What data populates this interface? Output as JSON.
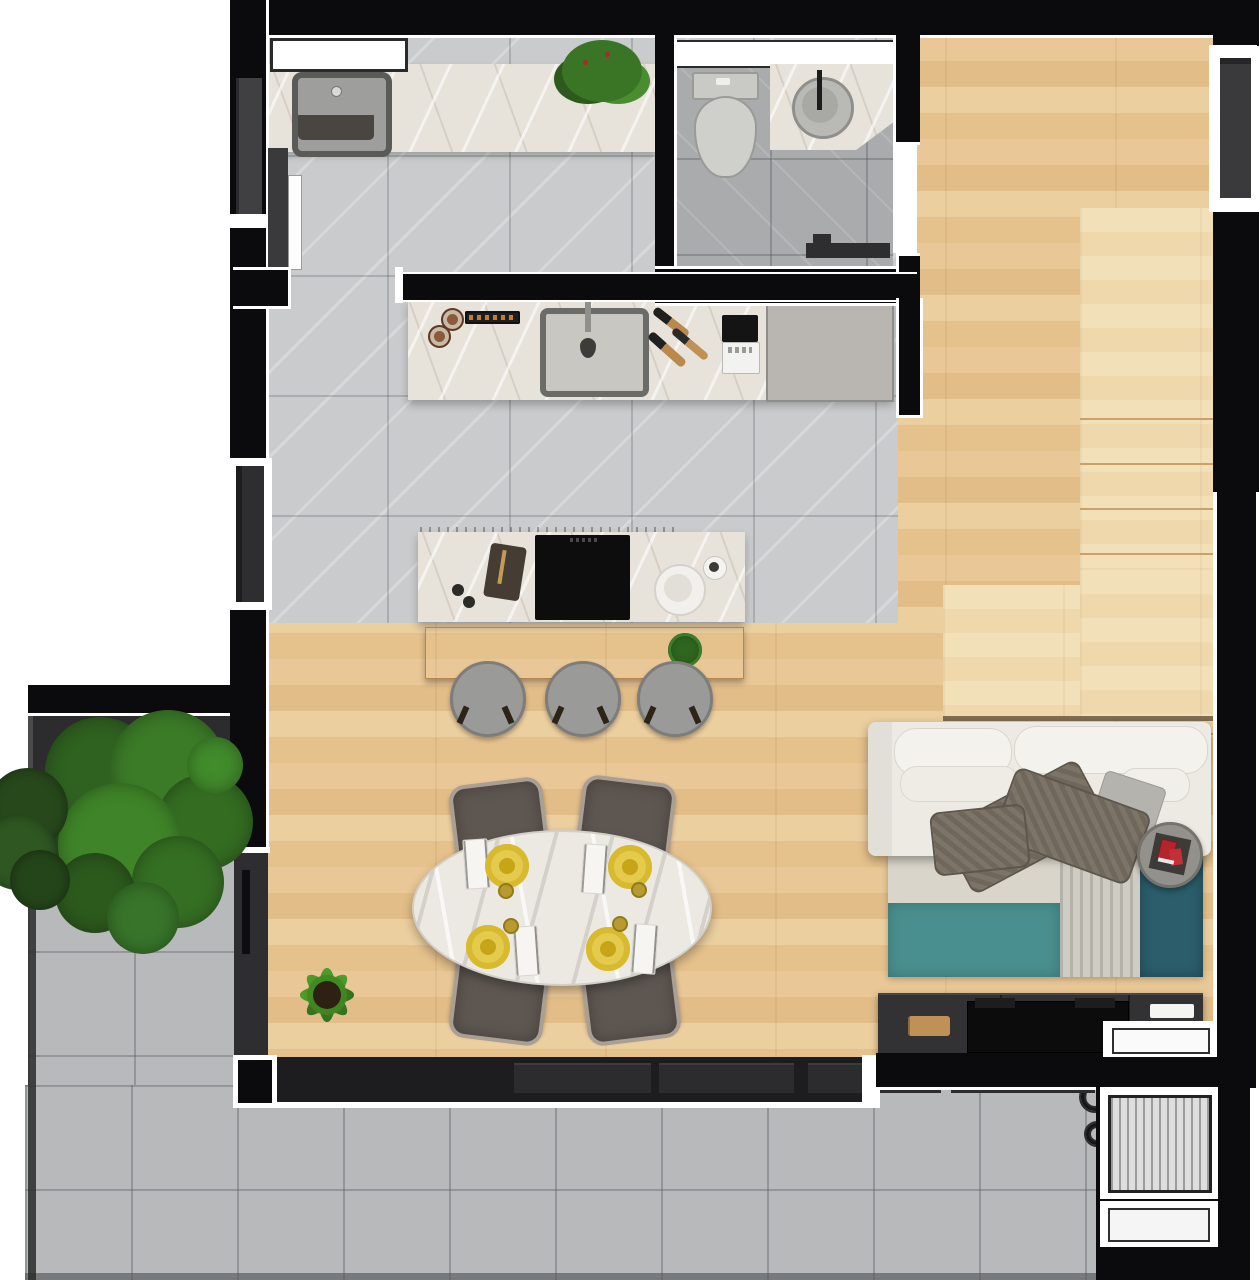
{
  "meta": {
    "kind": "apartment-floor-plan-render",
    "view": "top-down",
    "visible_text": "none"
  },
  "palette": {
    "wall_black": "#0b0b0d",
    "inner_seam_white": "#ffffff",
    "wood_floor": "#e7c493",
    "stair_wood_light": "#f0dcb2",
    "indoor_tile": "#c9cbcc",
    "wc_tile": "#a9abad",
    "outdoor_tile": "#b7b9ba",
    "marble_counter": "#e7e2da",
    "appliance_gray": "#b9b6b1",
    "cooktop_black": "#0d0d0e",
    "glass_dark": "#353538",
    "sofa_white": "#efece6",
    "blanket_taupe": "#6f675c",
    "rug_teal": "#4a8f8f",
    "rug_dark_teal": "#2b5d6b",
    "rug_base": "#d9d5ca",
    "console_dark": "#323234",
    "plate_yellow": "#d8ba2e",
    "accent_red": "#b3242c",
    "plant_green": "#3f7d2c",
    "stool_gray": "#9a9a98",
    "chair_brown": "#5e5751"
  },
  "rooms": [
    {
      "id": "laundry",
      "features": [
        "window",
        "counter",
        "square-sink",
        "plant"
      ]
    },
    {
      "id": "wc",
      "features": [
        "window",
        "toilet",
        "round-basin-vanity",
        "towel-rail",
        "door-opening"
      ]
    },
    {
      "id": "kitchen",
      "features": [
        "back-counter",
        "sink",
        "spice-rack",
        "coffee-maker",
        "appliance-panel",
        "island",
        "cooktop",
        "bench",
        "stools"
      ]
    },
    {
      "id": "dining",
      "features": [
        "oval-marble-table",
        "4-chairs",
        "4-plates",
        "floor-plant"
      ]
    },
    {
      "id": "living",
      "features": [
        "sofa",
        "blanket",
        "pillows",
        "side-table",
        "rug",
        "tv-console"
      ]
    },
    {
      "id": "stairs",
      "features": [
        "upper-flight",
        "landing",
        "lower-steps"
      ]
    },
    {
      "id": "terrace",
      "features": [
        "planter",
        "tree",
        "bush",
        "outdoor-tile"
      ]
    },
    {
      "id": "shaft-corner",
      "features": [
        "window-block",
        "hatched-block",
        "plain-block"
      ]
    }
  ],
  "counts": {
    "stair_treads": 8,
    "lower_steps": 3,
    "stools": 3,
    "dining_chairs": 4,
    "dinner_plates": 4,
    "glass_panels": 4,
    "cooktop_burners": 4
  },
  "stairs": {
    "treads": [
      {
        "y": 210
      },
      {
        "y": 255
      },
      {
        "y": 300
      },
      {
        "y": 345
      },
      {
        "y": 390
      },
      {
        "y": 435
      },
      {
        "y": 480
      },
      {
        "y": 525
      }
    ],
    "lower_steps": [
      {
        "x": 943
      },
      {
        "x": 989
      },
      {
        "x": 1035
      }
    ]
  },
  "glass_panels": [
    {
      "x": 281,
      "w": 137
    },
    {
      "x": 426,
      "w": 135
    },
    {
      "x": 575,
      "w": 133
    },
    {
      "x": 718,
      "w": 144
    }
  ],
  "stools": [
    {
      "cx": 485
    },
    {
      "cx": 580
    },
    {
      "cx": 672
    }
  ],
  "burners": [
    {
      "cx": 558,
      "cy": 560,
      "r": 14
    },
    {
      "cx": 603,
      "cy": 556,
      "r": 11
    },
    {
      "cx": 560,
      "cy": 597,
      "r": 11
    },
    {
      "cx": 606,
      "cy": 593,
      "r": 14
    }
  ],
  "chairs": [
    {
      "x": 452,
      "y": 781,
      "rot": -7
    },
    {
      "x": 579,
      "y": 779,
      "rot": 7
    },
    {
      "x": 452,
      "y": 960,
      "rot": 187
    },
    {
      "x": 584,
      "y": 960,
      "rot": 173
    }
  ],
  "plates": [
    {
      "cx": 507,
      "cy": 866
    },
    {
      "cx": 630,
      "cy": 867
    },
    {
      "cx": 488,
      "cy": 947
    },
    {
      "cx": 608,
      "cy": 949
    }
  ],
  "napkins": [
    {
      "x": 464,
      "y": 839,
      "rot": -4
    },
    {
      "x": 582,
      "y": 844,
      "rot": 4
    },
    {
      "x": 514,
      "y": 926,
      "rot": -4
    },
    {
      "x": 632,
      "y": 924,
      "rot": 4
    }
  ],
  "cups": [
    {
      "cx": 504,
      "cy": 889
    },
    {
      "cx": 637,
      "cy": 888
    },
    {
      "cx": 509,
      "cy": 924
    },
    {
      "cx": 618,
      "cy": 922
    }
  ],
  "tree_blobs": [
    {
      "cx": 138,
      "cy": 825,
      "r": 92,
      "color": "#23481a"
    },
    {
      "cx": 100,
      "cy": 772,
      "r": 55,
      "color": "#2f6120"
    },
    {
      "cx": 168,
      "cy": 768,
      "r": 58,
      "color": "#3b7a27"
    },
    {
      "cx": 205,
      "cy": 822,
      "r": 48,
      "color": "#346c22"
    },
    {
      "cx": 120,
      "cy": 845,
      "r": 62,
      "color": "#3f8428"
    },
    {
      "cx": 178,
      "cy": 882,
      "r": 46,
      "color": "#356f23"
    },
    {
      "cx": 95,
      "cy": 893,
      "r": 40,
      "color": "#2c5a1d"
    },
    {
      "cx": 143,
      "cy": 918,
      "r": 36,
      "color": "#38752a"
    },
    {
      "cx": 215,
      "cy": 765,
      "r": 28,
      "color": "#428c2c"
    }
  ],
  "bush_blobs": [
    {
      "cx": 28,
      "cy": 808,
      "r": 40,
      "color": "#27481b"
    },
    {
      "cx": 18,
      "cy": 852,
      "r": 38,
      "color": "#2f5722"
    },
    {
      "cx": 40,
      "cy": 880,
      "r": 30,
      "color": "#24451a"
    }
  ],
  "plant_leaves": [
    {
      "rot": 0
    },
    {
      "rot": 45
    },
    {
      "rot": 90
    },
    {
      "rot": 135
    },
    {
      "rot": 180
    },
    {
      "rot": 225
    },
    {
      "rot": 270
    },
    {
      "rot": 315
    }
  ]
}
